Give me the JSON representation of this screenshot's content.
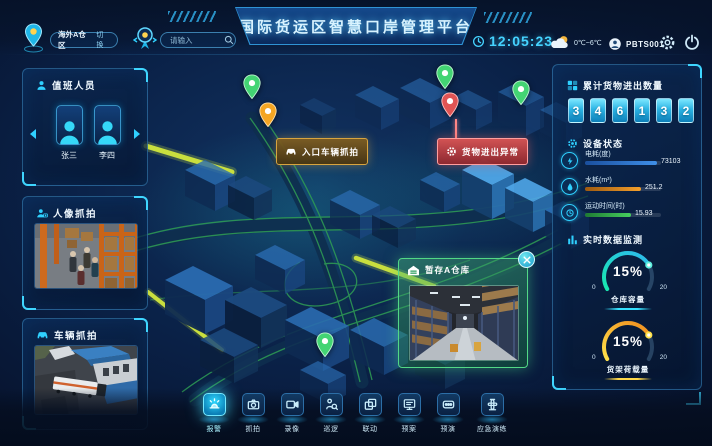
{
  "header": {
    "region": {
      "name": "海外A仓区",
      "switch": "切换"
    },
    "search": {
      "placeholder": "请输入"
    },
    "title": "国际货运区智慧口岸管理平台",
    "time": "12:05:23",
    "weather": "0℃~6℃",
    "user": "PBTS001"
  },
  "left": {
    "duty": {
      "title": "值班人员",
      "members": [
        {
          "name": "张三"
        },
        {
          "name": "李四"
        }
      ]
    },
    "face_capture": {
      "title": "人像抓拍"
    },
    "vehicle_capture": {
      "title": "车辆抓拍"
    }
  },
  "map": {
    "entry_label": "入口车辆抓拍",
    "alert_label": "货物进出异常",
    "warehouse_popup": {
      "title": "暂存A仓库"
    }
  },
  "right": {
    "cargo": {
      "title": "累计货物进出数量",
      "digits": [
        "3",
        "4",
        "6",
        "1",
        "3",
        "2"
      ]
    },
    "device": {
      "title": "设备状态",
      "items": [
        {
          "label": "电耗(度)",
          "value": "73103"
        },
        {
          "label": "水耗(m³)",
          "value": "251.2"
        },
        {
          "label": "运动时间(时)",
          "value": "15.93"
        }
      ]
    },
    "realtime": {
      "title": "实时数据监测",
      "gauges": [
        {
          "value": "15%",
          "label": "仓库容量",
          "min": "0",
          "max": "20"
        },
        {
          "value": "15%",
          "label": "货架荷载量",
          "min": "0",
          "max": "20"
        }
      ]
    }
  },
  "toolbar": {
    "items": [
      {
        "label": "报警"
      },
      {
        "label": "抓拍"
      },
      {
        "label": "录像"
      },
      {
        "label": "巡逻"
      },
      {
        "label": "联动"
      },
      {
        "label": "预案"
      },
      {
        "label": "预演"
      },
      {
        "label": "应急演练"
      }
    ]
  },
  "colors": {
    "accent": "#35d4ff",
    "bar_electric": "#3f8fe8",
    "bar_water": "#f5a02c",
    "bar_time": "#46cf5e",
    "gauge_warehouse": "#23d8c4",
    "gauge_shelf": "#f0a62a",
    "pin_green": "#43d473",
    "pin_orange": "#f5a623",
    "pin_red": "#e05454"
  }
}
